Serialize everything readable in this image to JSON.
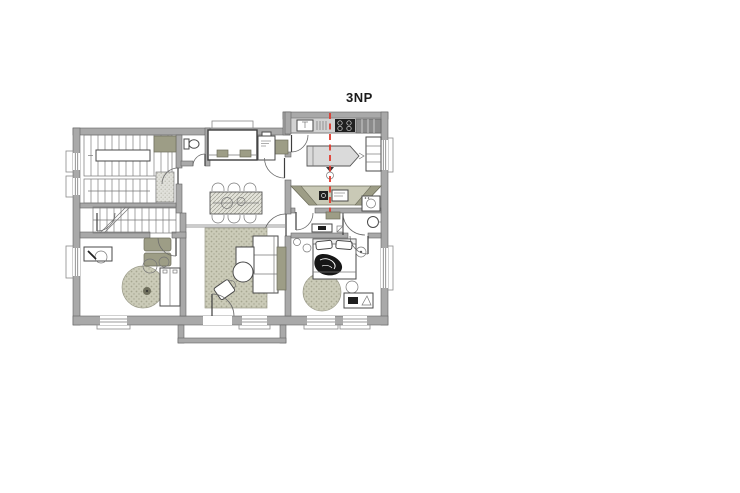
{
  "plan": {
    "floor_label": "3NP",
    "colors": {
      "wall": "#a9a9a9",
      "wall_outline": "#636363",
      "furniture_olive": "#9d9d86",
      "counter": "#d2d2d2",
      "cabinet_dark": "#8b8b8b",
      "rug": "#cbcbb8",
      "rug_dot": "#a6a691",
      "appliance_dark": "#1f1f1f",
      "section_line_red": "#e03a2e"
    },
    "rooms": [
      "staircase",
      "wc",
      "dining-room",
      "kitchen",
      "hallway",
      "bedroom-right",
      "living-room",
      "bedroom-left",
      "balcony"
    ]
  }
}
